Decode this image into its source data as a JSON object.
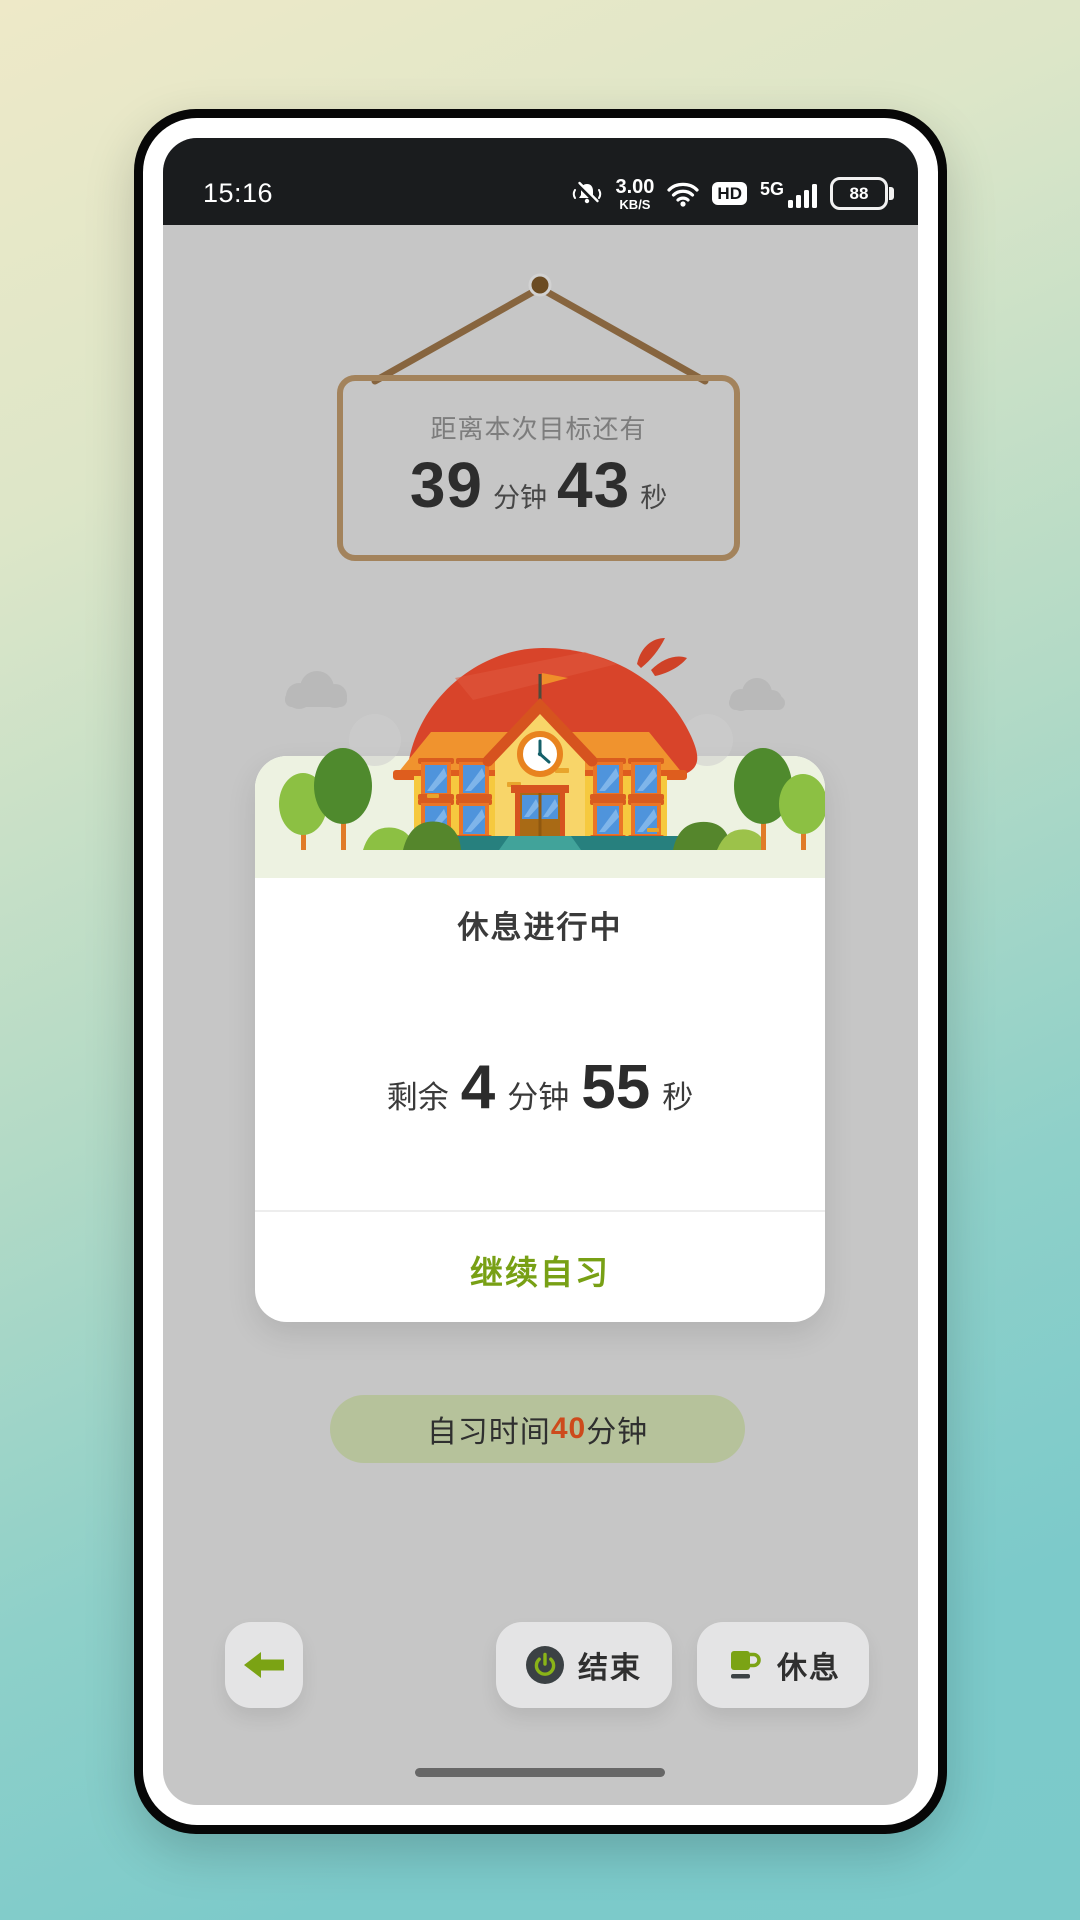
{
  "statusbar": {
    "time": "15:16",
    "net_speed": {
      "value": "3.00",
      "unit": "KB/S"
    },
    "hd": "HD",
    "network": "5G",
    "battery": "88",
    "icons": [
      "mute-vibrate-icon",
      "wifi-icon",
      "hd-badge",
      "signal-bars",
      "battery-icon"
    ]
  },
  "goal_sign": {
    "caption": "距离本次目标还有",
    "minutes": "39",
    "minutes_unit": "分钟",
    "seconds": "43",
    "seconds_unit": "秒"
  },
  "rest_card": {
    "title": "休息进行中",
    "remaining_label": "剩余",
    "minutes": "4",
    "minutes_unit": "分钟",
    "seconds": "55",
    "seconds_unit": "秒",
    "continue_label": "继续自习"
  },
  "session_pill": {
    "prefix": "自习时间",
    "minutes": "40",
    "suffix": "分钟"
  },
  "footer": {
    "end_label": "结束",
    "rest_label": "休息",
    "icons": [
      "back-arrow-icon",
      "power-icon",
      "cup-icon"
    ]
  },
  "colors": {
    "accent_green": "#7aa116",
    "highlight_red": "#cd4a1c",
    "sign_brown": "#a3835c",
    "screen_bg": "#c6c6c6",
    "band_green": "#edf2e1",
    "pill_green": "#b6c29b",
    "statusbar_bg": "#1a1c1e"
  }
}
